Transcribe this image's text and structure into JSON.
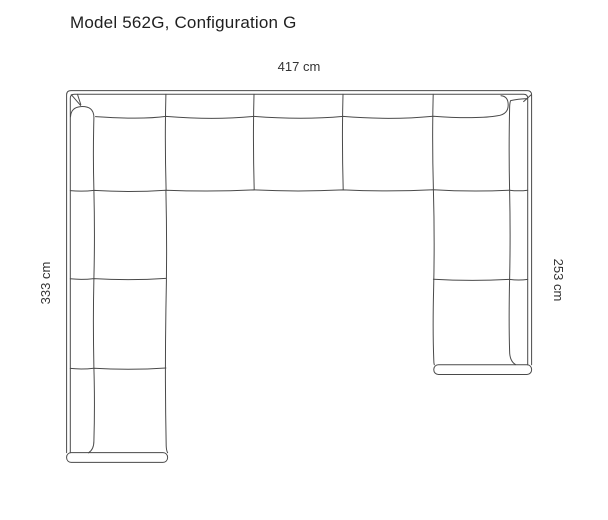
{
  "title": "Model 562G, Configuration G",
  "diagram": {
    "model": "562G",
    "configuration": "G",
    "dimensions": {
      "top_width": "417 cm",
      "left_depth": "333 cm",
      "right_depth": "253 cm"
    },
    "style": {
      "line_color": "#4a4a4a",
      "label_color": "#333333",
      "title_color": "#1f1f1f",
      "background": "#ffffff"
    }
  }
}
